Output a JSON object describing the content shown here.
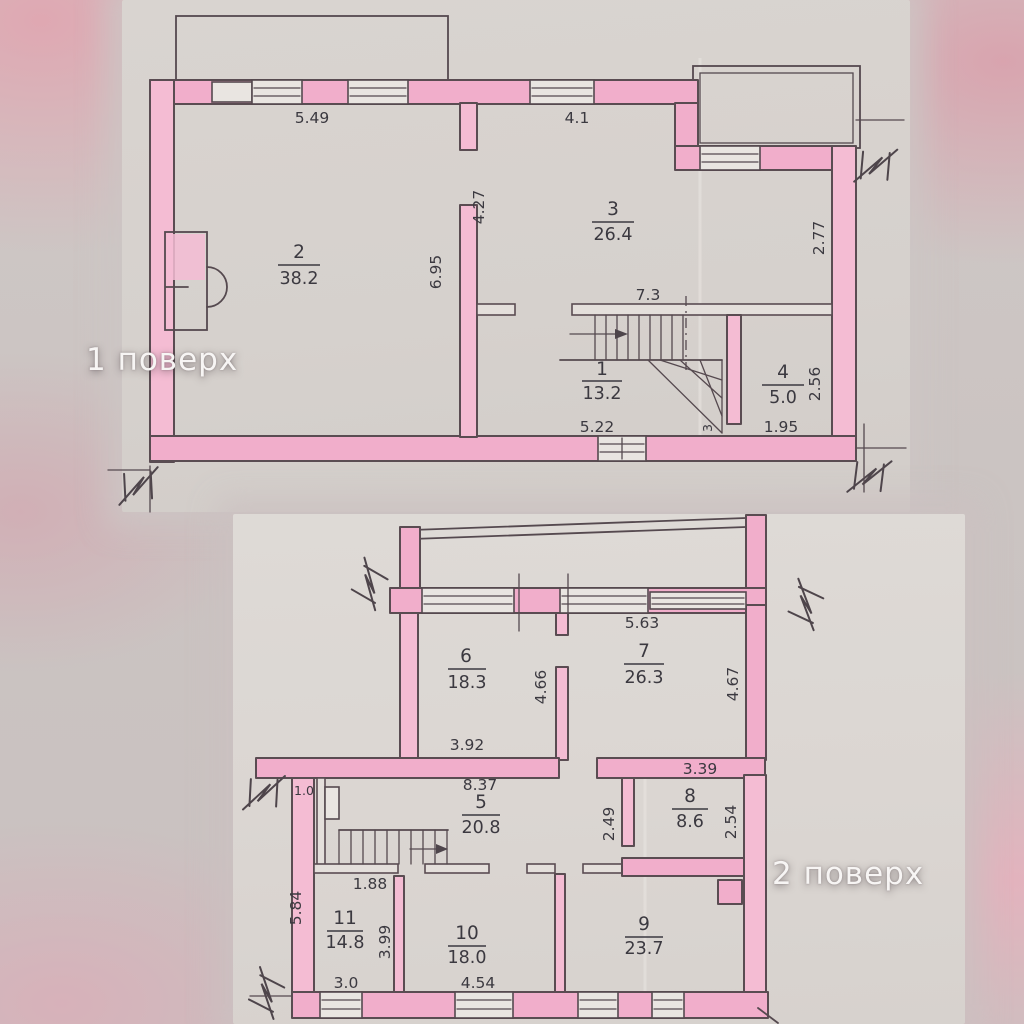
{
  "floor1": {
    "label": "1 поверх",
    "rooms": {
      "r1": {
        "number": "1",
        "area": "13.2"
      },
      "r2": {
        "number": "2",
        "area": "38.2"
      },
      "r3": {
        "number": "3",
        "area": "26.4"
      },
      "r4": {
        "number": "4",
        "area": "5.0"
      }
    },
    "dims": {
      "d549": "5.49",
      "d41": "4.1",
      "d427": "4.27",
      "d695": "6.95",
      "d277": "2.77",
      "d73": "7.3",
      "d256": "2.56",
      "d522": "5.22",
      "d195": "1.95",
      "d3": "3"
    }
  },
  "floor2": {
    "label": "2 поверх",
    "rooms": {
      "r5": {
        "number": "5",
        "area": "20.8"
      },
      "r6": {
        "number": "6",
        "area": "18.3"
      },
      "r7": {
        "number": "7",
        "area": "26.3"
      },
      "r8": {
        "number": "8",
        "area": "8.6"
      },
      "r9": {
        "number": "9",
        "area": "23.7"
      },
      "r10": {
        "number": "10",
        "area": "18.0"
      },
      "r11": {
        "number": "11",
        "area": "14.8"
      }
    },
    "dims": {
      "d563": "5.63",
      "d466": "4.66",
      "d467": "4.67",
      "d392": "3.92",
      "d10": "1.0",
      "d837": "8.37",
      "d339": "3.39",
      "d249": "2.49",
      "d254": "2.54",
      "d188": "1.88",
      "d584": "5.84",
      "d399": "3.99",
      "d30": "3.0",
      "d454": "4.54"
    }
  },
  "colors": {
    "wall_highlight": "#f1aecb",
    "paper": "#d9d4d0",
    "ink": "#55494f"
  }
}
